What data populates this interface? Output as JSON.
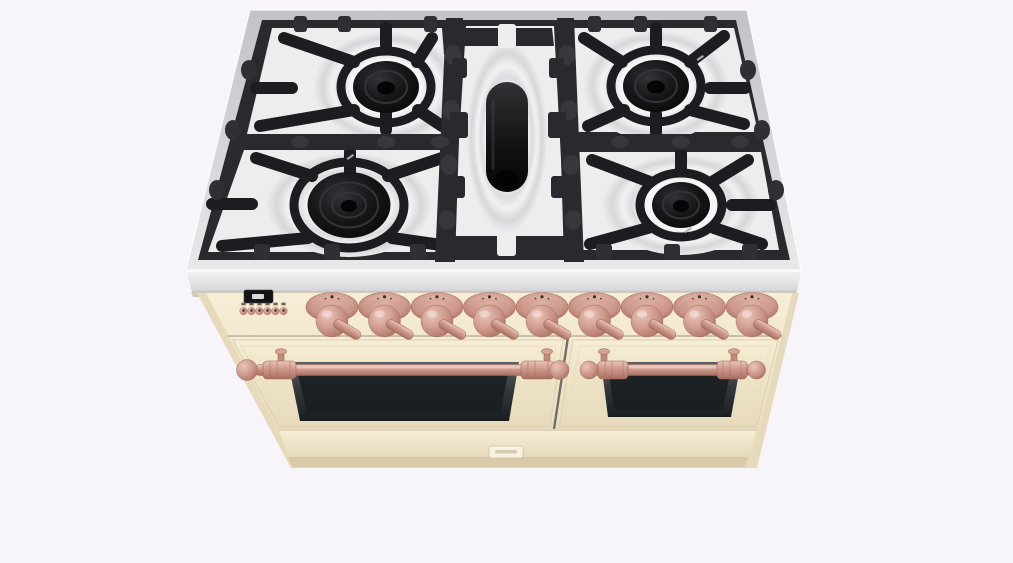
{
  "scene": {
    "description": "3D render of a freestanding five-burner dual-oven range cooker in cream with copper trim, viewed from the front top",
    "background_color": "#f7f5fa"
  },
  "colors": {
    "background": "#f7f5fa",
    "steel_bright": "#f4f4f6",
    "steel_light": "#e9e9ec",
    "steel_mid": "#d4d4d8",
    "steel_dark": "#c2c2c7",
    "grate_dark": "#2a2a2e",
    "grate_edge": "#1d1d21",
    "grate_hi": "#37373c",
    "pan_bright": "#fdfdfd",
    "pan_silver": "#ededee",
    "pan_shadow": "#c9c9cc",
    "burner_black": "#0b0b0d",
    "burner_ring": "#333338",
    "cream_light": "#f7eed7",
    "cream": "#f0e6cb",
    "cream_dark": "#e7dabc",
    "cream_deep": "#d9cba9",
    "cream_shadow": "#bdb197",
    "copper_light": "#ecc5b9",
    "copper": "#cd988c",
    "copper_dark": "#a96f60",
    "glass_light": "#5c6064",
    "glass_dark": "#1b1e21",
    "display_bg": "#141417",
    "display_glow": "#eceef0",
    "gap_line": "#6e6e68"
  },
  "cooktop": {
    "label": "Gas cooktop with cast-iron grates",
    "burner_count": 5,
    "burners": [
      {
        "id": "rear-left-burner",
        "shape": "round"
      },
      {
        "id": "front-left-burner",
        "shape": "round-wok"
      },
      {
        "id": "center-burner",
        "shape": "oval"
      },
      {
        "id": "rear-right-burner",
        "shape": "round"
      },
      {
        "id": "front-right-burner",
        "shape": "round"
      }
    ]
  },
  "control_panel": {
    "display_label": "digital clock display",
    "button_count": 6,
    "buttons_label": "clock and timer buttons",
    "knob_count": 9,
    "knobs_label": "burner and oven control knobs",
    "knob_finish": "copper"
  },
  "ovens": {
    "door_count": 2,
    "left_door_label": "main oven door",
    "right_door_label": "secondary oven door",
    "handle_finish": "copper"
  }
}
